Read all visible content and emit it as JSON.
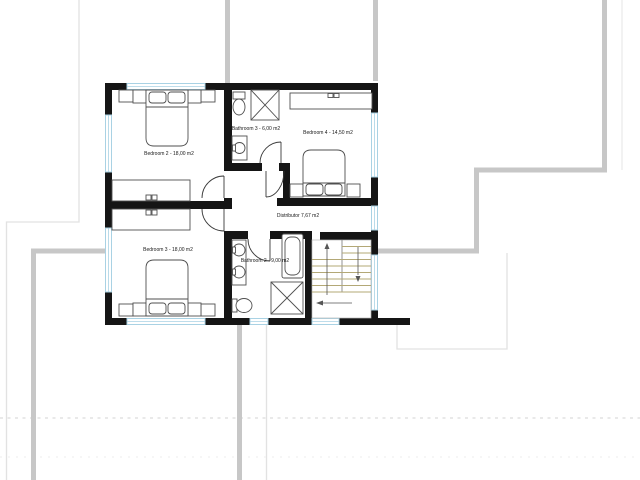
{
  "floor_plan": {
    "rooms": [
      {
        "name": "bedroom-2",
        "label": "Bedroom 2 - 18,00 m2"
      },
      {
        "name": "bathroom-3",
        "label": "Bathroom 3 - 6,00 m2"
      },
      {
        "name": "bedroom-4",
        "label": "Bedroom 4 - 14,50 m2"
      },
      {
        "name": "distributor",
        "label": "Distributor 7,67 m2"
      },
      {
        "name": "bedroom-3",
        "label": "Bedroom 3 - 18,00 m2"
      },
      {
        "name": "bathroom-2",
        "label": "Bathroom 2 - 9,00 m2"
      }
    ],
    "colors": {
      "wall": "#151515",
      "window": "#a9d2e4",
      "stair_tread": "#b3a876",
      "context_wall": "#c7c7c7",
      "faint_line": "#e2e2e2",
      "furniture_outline": "#4f4f4f",
      "background": "#ffffff"
    }
  }
}
